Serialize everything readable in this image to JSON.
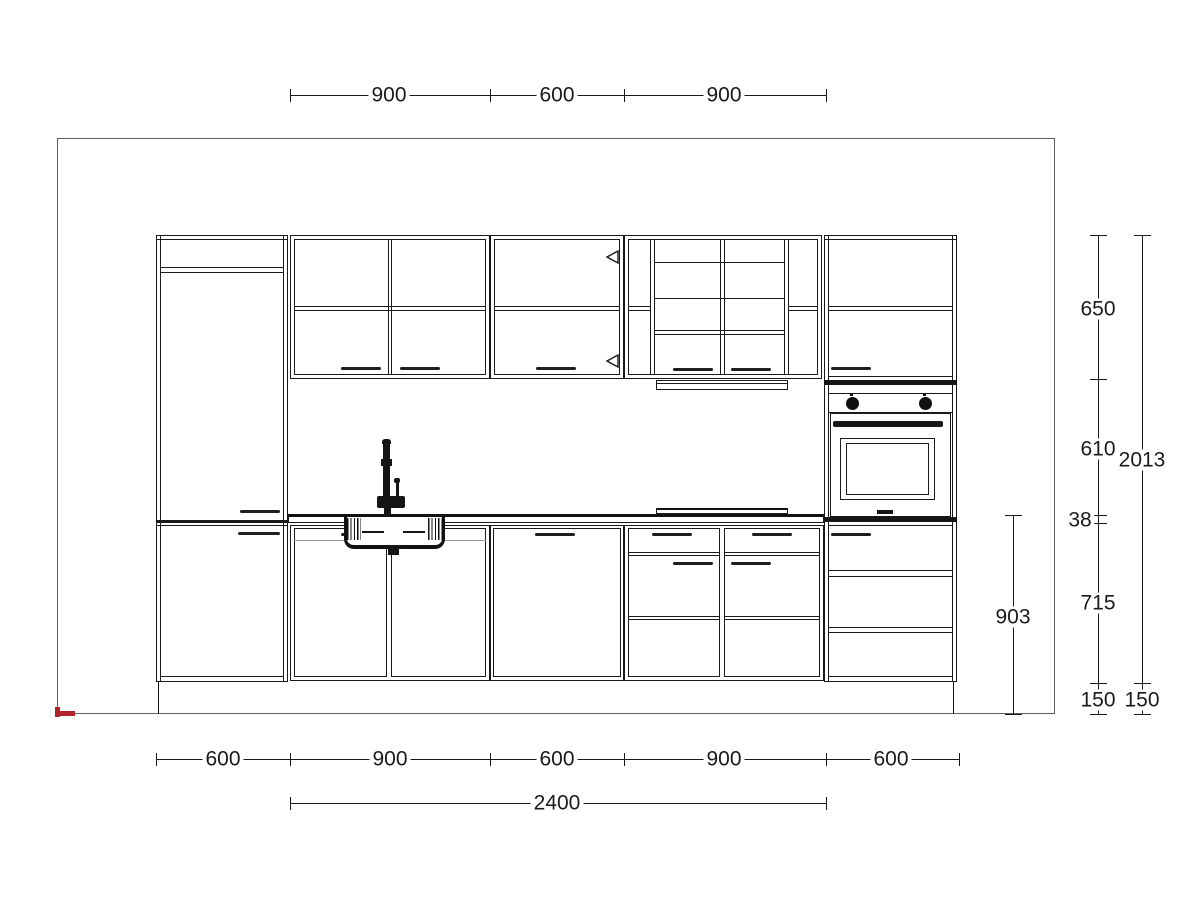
{
  "drawing": {
    "kind": "kitchen cabinetry elevation",
    "oven_brand_mark": "visible as small dark mark on oven door",
    "colors": {
      "line": "#1a1a1a",
      "frame_border": "#5f5f5f",
      "accent_red": "#b5232a",
      "muted_gray": "#9a9a9a"
    }
  },
  "measurements_mm": {
    "wall_run_segments": [
      900,
      600,
      900
    ],
    "wall_run_total": 2400,
    "base_run_segments": [
      600,
      900,
      600,
      900,
      600
    ],
    "heights": {
      "wall_cabinet": 650,
      "wall_to_counter_gap": 610,
      "countertop_thickness": 38,
      "base_cabinet": 715,
      "plinth": 150,
      "total_cabinetry": 2013,
      "countertop_to_floor": 903
    }
  },
  "dimension_labels": [
    {
      "id": "top-900-left",
      "text": "900",
      "x": 389,
      "y": 95
    },
    {
      "id": "top-600-center",
      "text": "600",
      "x": 557,
      "y": 95
    },
    {
      "id": "top-900-right",
      "text": "900",
      "x": 724,
      "y": 95
    },
    {
      "id": "bottom-600-1",
      "text": "600",
      "x": 223,
      "y": 759
    },
    {
      "id": "bottom-900-1",
      "text": "900",
      "x": 390,
      "y": 759
    },
    {
      "id": "bottom-600-2",
      "text": "600",
      "x": 557,
      "y": 759
    },
    {
      "id": "bottom-900-2",
      "text": "900",
      "x": 724,
      "y": 759
    },
    {
      "id": "bottom-600-3",
      "text": "600",
      "x": 891,
      "y": 759
    },
    {
      "id": "bottom-2400",
      "text": "2400",
      "x": 557,
      "y": 803
    },
    {
      "id": "right-650",
      "text": "650",
      "x": 1098,
      "y": 309
    },
    {
      "id": "right-610",
      "text": "610",
      "x": 1098,
      "y": 449
    },
    {
      "id": "right-2013",
      "text": "2013",
      "x": 1142,
      "y": 460
    },
    {
      "id": "right-38",
      "text": "38",
      "x": 1080,
      "y": 520
    },
    {
      "id": "right-715",
      "text": "715",
      "x": 1098,
      "y": 603
    },
    {
      "id": "right-903",
      "text": "903",
      "x": 1013,
      "y": 617
    },
    {
      "id": "right-150-inner",
      "text": "150",
      "x": 1098,
      "y": 700
    },
    {
      "id": "right-150-outer",
      "text": "150",
      "x": 1142,
      "y": 700
    }
  ]
}
